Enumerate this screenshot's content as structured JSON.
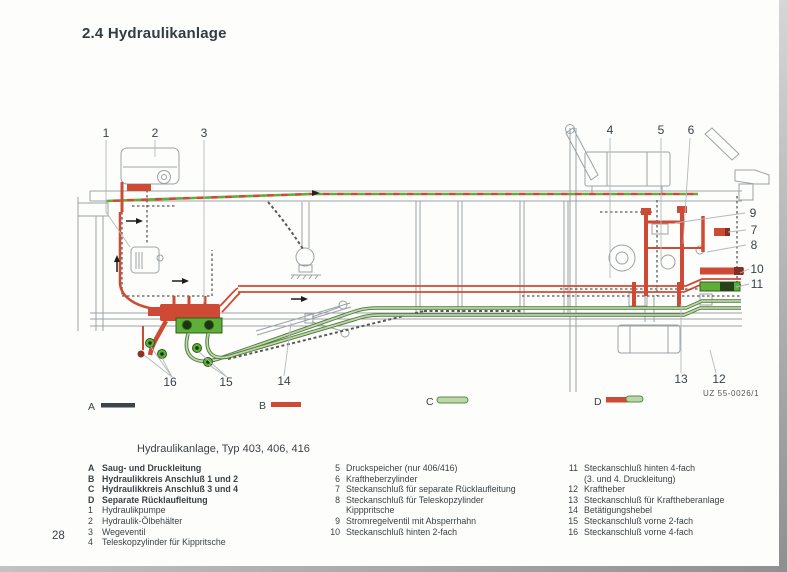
{
  "page": {
    "title": "2.4 Hydraulikanlage",
    "caption": "Hydraulikanlage, Typ 403, 406, 416",
    "page_number": "28",
    "figure_code": "UZ 55-0026/1"
  },
  "colors": {
    "line_red": "#cf4a35",
    "line_green_pale": "#bcd6aa",
    "line_green_dark": "#4e7a3a",
    "connector_green": "#5fae3a",
    "swatch_dark": "#3d4449",
    "text_dark": "#38424a"
  },
  "diagram": {
    "callouts": {
      "c1": "1",
      "c2": "2",
      "c3": "3",
      "c4": "4",
      "c5": "5",
      "c6": "6",
      "c7": "7",
      "c8": "8",
      "c9": "9",
      "c10": "10",
      "c11": "11",
      "c12": "12",
      "c13": "13",
      "c14": "14",
      "c15": "15",
      "c16": "16"
    },
    "swatches": {
      "a": "A",
      "b": "B",
      "c": "C",
      "d": "D"
    }
  },
  "legend": {
    "col1": [
      {
        "key": "A",
        "text": "Saug- und Druckleitung",
        "bold": true
      },
      {
        "key": "B",
        "text": "Hydraulikkreis Anschluß 1 und 2",
        "bold": true
      },
      {
        "key": "C",
        "text": "Hydraulikkreis Anschluß 3 und 4",
        "bold": true
      },
      {
        "key": "D",
        "text": "Separate Rücklaufleitung",
        "bold": true
      },
      {
        "key": "1",
        "text": "Hydraulikpumpe"
      },
      {
        "key": "2",
        "text": "Hydraulik-Ölbehälter"
      },
      {
        "key": "3",
        "text": "Wegeventil"
      },
      {
        "key": "4",
        "text": "Teleskopzylinder für Kippritsche"
      }
    ],
    "col2": [
      {
        "key": "5",
        "text": "Druckspeicher (nur 406/416)"
      },
      {
        "key": "6",
        "text": "Kraftheberzylinder"
      },
      {
        "key": "7",
        "text": "Steckanschluß für separate Rücklaufleitung"
      },
      {
        "key": "8",
        "text": "Steckanschluß für Teleskopzylinder"
      },
      {
        "key": "",
        "text": "Kipppritsche"
      },
      {
        "key": "9",
        "text": "Stromregelventil mit Absperrhahn"
      },
      {
        "key": "10",
        "text": "Steckanschluß hinten 2-fach"
      }
    ],
    "col3": [
      {
        "key": "11",
        "text": "Steckanschluß hinten 4-fach"
      },
      {
        "key": "",
        "text": "(3. und 4. Druckleitung)"
      },
      {
        "key": "12",
        "text": "Kraftheber"
      },
      {
        "key": "13",
        "text": "Steckanschluß für Kraftheberanlage"
      },
      {
        "key": "14",
        "text": "Betätigungshebel"
      },
      {
        "key": "15",
        "text": "Steckanschluß vorne 2-fach"
      },
      {
        "key": "16",
        "text": "Steckanschluß vorne 4-fach"
      }
    ]
  }
}
